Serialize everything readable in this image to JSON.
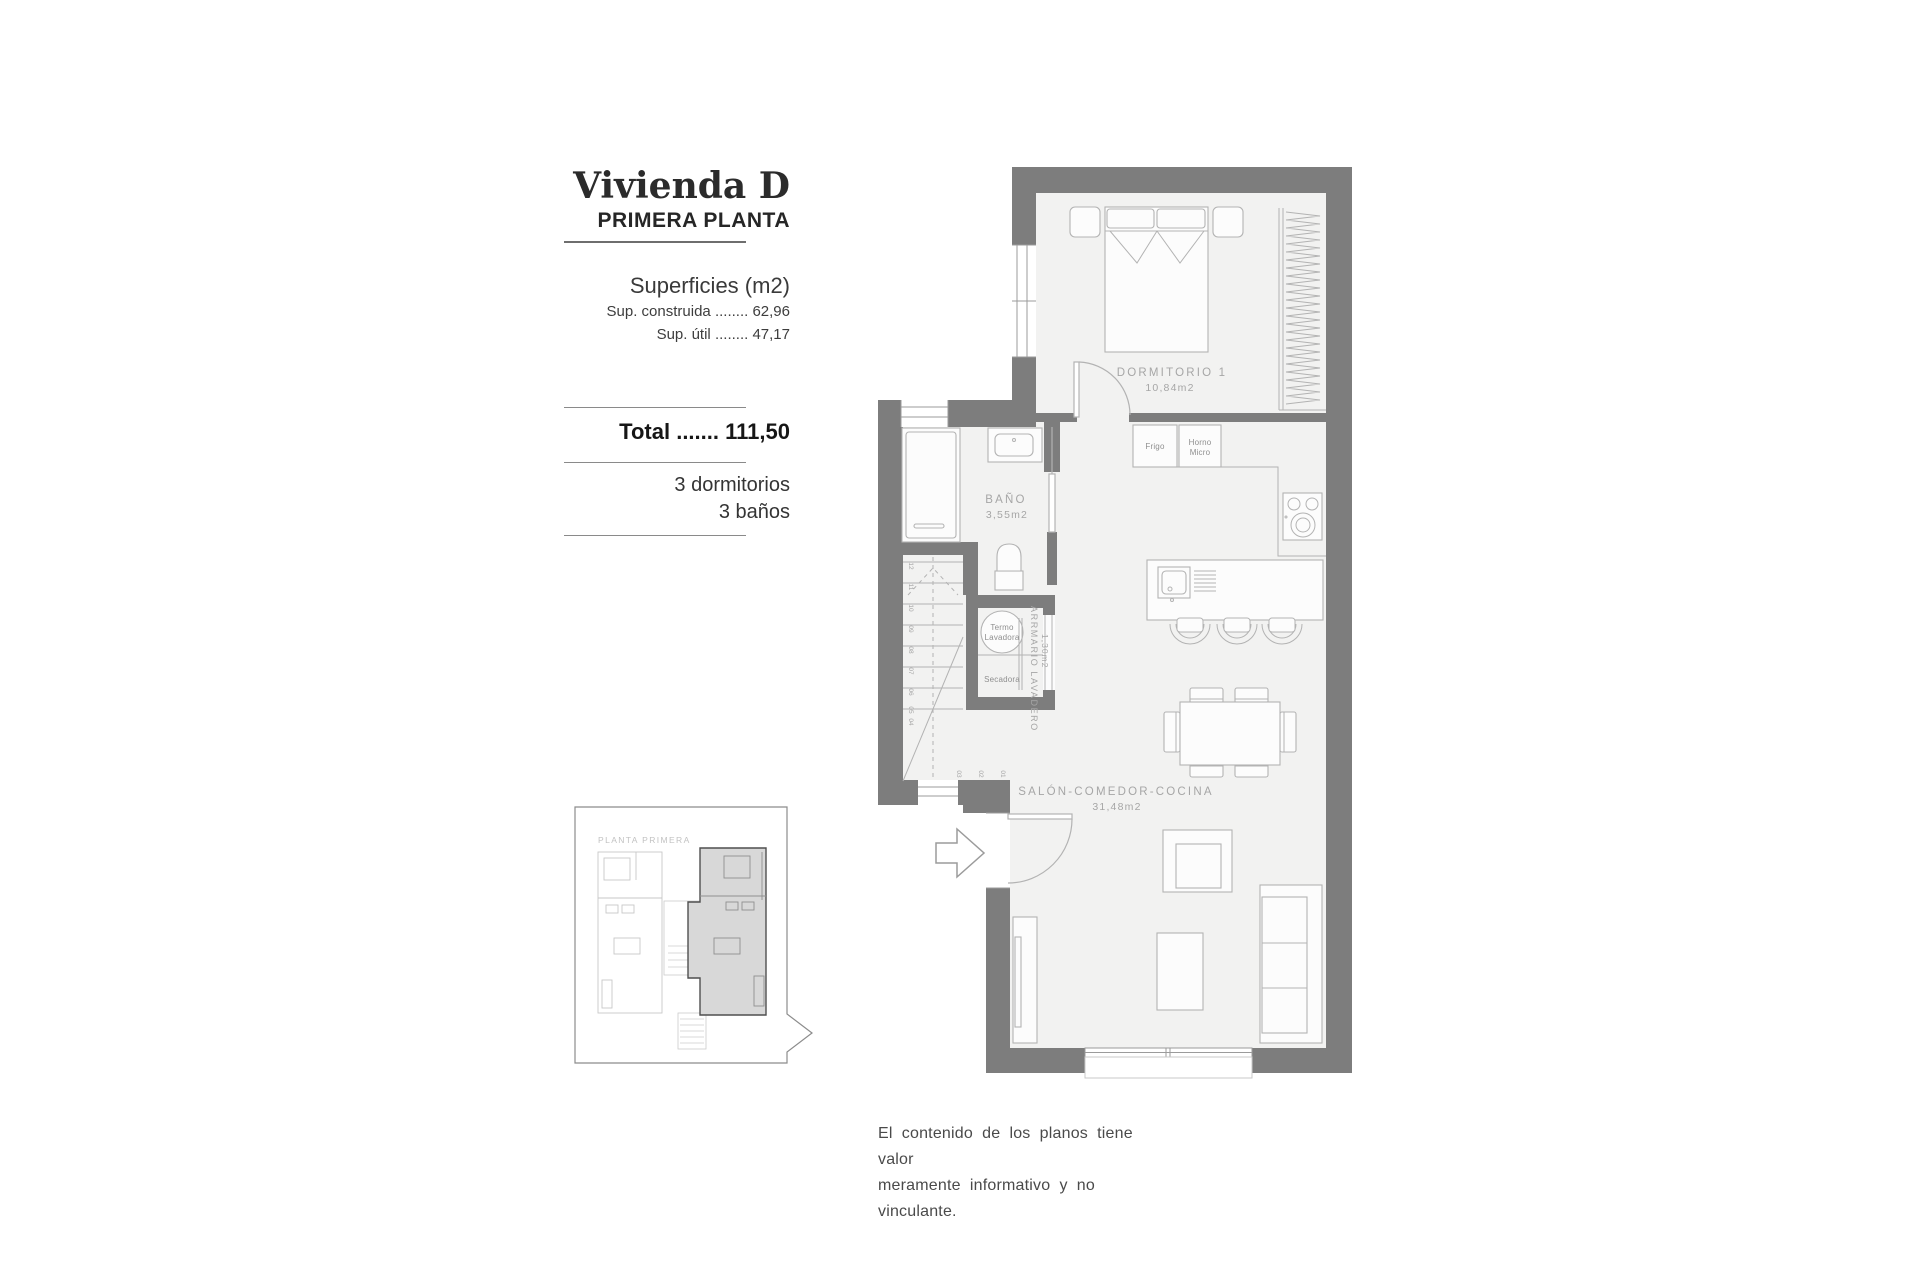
{
  "colors": {
    "wall": "#7d7d7d",
    "floor": "#f2f2f1",
    "line": "#b3b3b3",
    "line_dark": "#9b9b9b",
    "label": "#a6a6a6",
    "label_dark": "#8f8f8f",
    "mini_fill": "#d8d8d8",
    "mini_outline": "#4f4f4f"
  },
  "info_panel": {
    "title": "Vivienda D",
    "subtitle": "PRIMERA PLANTA",
    "surfaces_heading": "Superficies (m2)",
    "surfaces": [
      {
        "label": "Sup. construida",
        "dots": "........",
        "value": "62,96"
      },
      {
        "label": "Sup. útil",
        "dots": "........",
        "value": "47,17"
      }
    ],
    "total_label": "Total",
    "total_dots": ".......",
    "total_value": "111,50",
    "features": [
      "3 dormitorios",
      "3 baños"
    ]
  },
  "mini_plan": {
    "label": "PLANTA PRIMERA"
  },
  "plan": {
    "rooms": {
      "dormitorio": {
        "name": "DORMITORIO 1",
        "area": "10,84m2"
      },
      "bano": {
        "name": "BAÑO",
        "area": "3,55m2"
      },
      "salon": {
        "name": "SALÓN-COMEDOR-COCINA",
        "area": "31,48m2"
      },
      "armario": {
        "name": "ARRMARIO LAVADERO",
        "area": "1,30m2"
      }
    },
    "fixtures": {
      "frigo": "Frigo",
      "horno_line1": "Horno",
      "horno_line2": "Micro",
      "termo_line1": "Termo",
      "termo_line2": "Lavadora",
      "secadora": "Secadora"
    },
    "stairs": {
      "upper": [
        "12",
        "11",
        "10",
        "09",
        "08",
        "07",
        "06",
        "05",
        "04"
      ],
      "lower": [
        "03",
        "02",
        "01"
      ]
    }
  },
  "disclaimer": [
    "El contenido de los planos tiene valor",
    "meramente informativo y no vinculante."
  ]
}
